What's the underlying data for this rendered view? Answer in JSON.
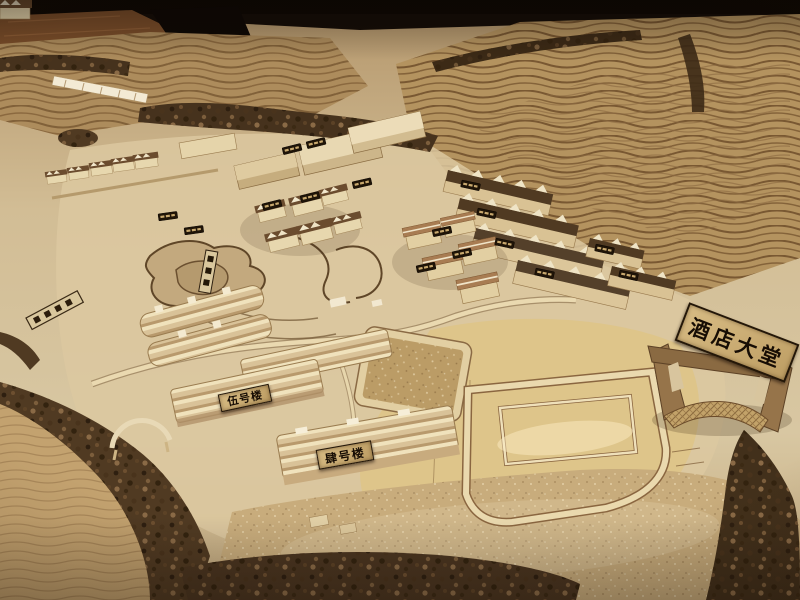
{
  "signs": {
    "hotel_lobby": {
      "text": "酒店大堂"
    },
    "building_five": {
      "text": "伍号楼"
    },
    "building_four": {
      "text": "肆号楼"
    }
  },
  "colors": {
    "table_dark": "#150d07",
    "wood_floor": "#7b4e2a",
    "terrain_light": "#d8c7a2",
    "terrain_mid": "#b4935f",
    "contour_line": "#6e4e2a",
    "tree_dark": "#46321d",
    "building_wood": "#e7d7ae",
    "roof_dark": "#503a22",
    "plaque_background": "#c9ab72",
    "plaque_text": "#170d04"
  }
}
